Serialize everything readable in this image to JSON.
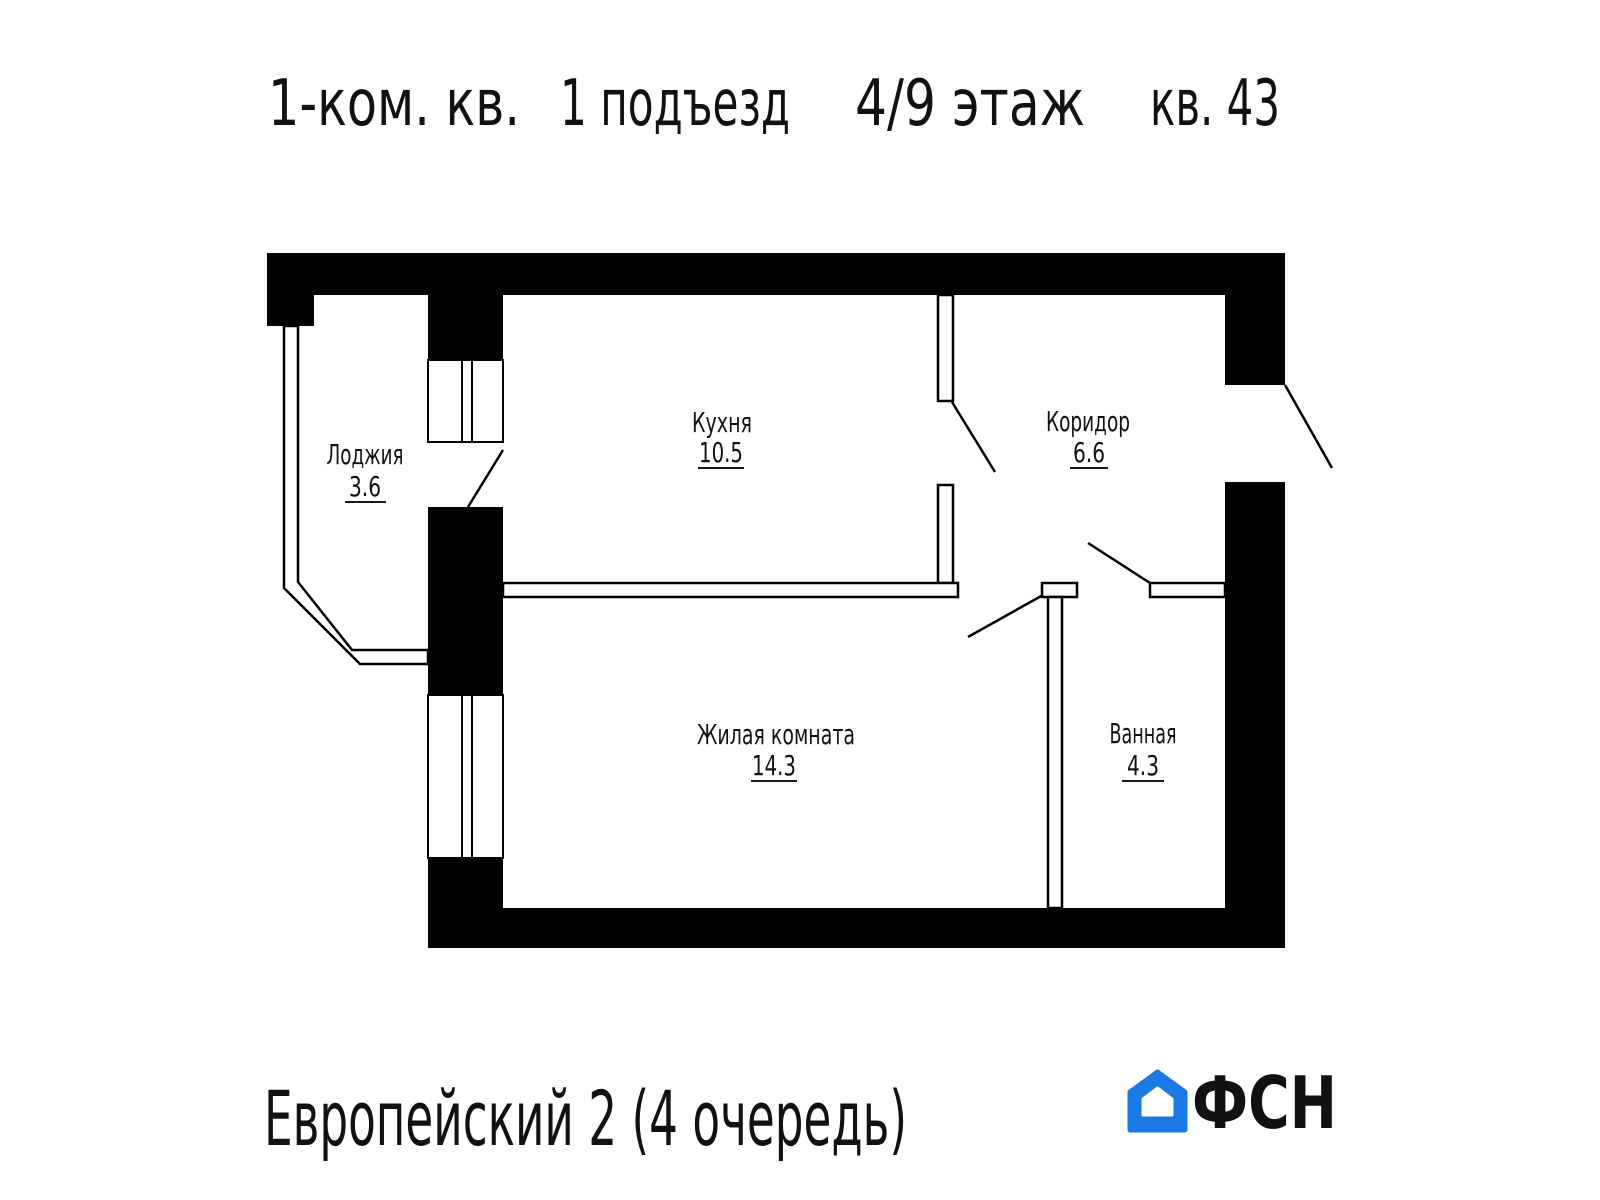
{
  "title": {
    "parts": [
      "1-ком. кв.",
      "1 подъезд",
      "4/9 этаж",
      "кв. 43"
    ]
  },
  "plan": {
    "rooms": [
      {
        "name": "Лоджия",
        "area": "3.6"
      },
      {
        "name": "Кухня",
        "area": "10.5"
      },
      {
        "name": "Коридор",
        "area": "6.6"
      },
      {
        "name": "Жилая комната",
        "area": "14.3"
      },
      {
        "name": "Ванная",
        "area": "4.3"
      }
    ]
  },
  "footer": {
    "project": "Европейский 2 (4 очередь)",
    "logo": {
      "text": "ФСН",
      "blue": "#1b79e6",
      "text_color": "#20242e"
    }
  },
  "colors": {
    "line": "#000000",
    "background": "#ffffff"
  }
}
